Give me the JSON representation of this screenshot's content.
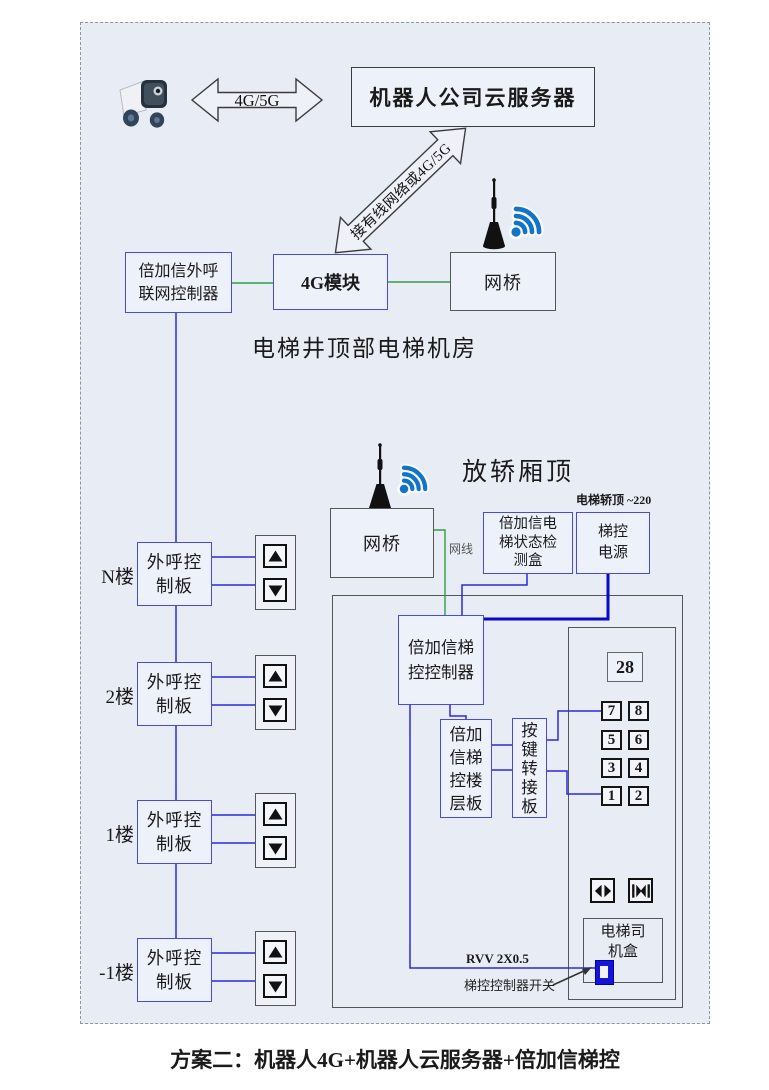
{
  "colors": {
    "page_bg": "#ffffff",
    "diagram_bg": "#e8edf5",
    "blue_box_border": "#4a4ae0",
    "gray_box_border": "#565656",
    "signal_line_blue": "#2a2ae0",
    "power_line_blue": "#0808cc",
    "network_line_green": "#2f9e43",
    "wifi_blue": "#1273c8",
    "switch_blue": "#1414d6"
  },
  "icons": {
    "robot": "delivery-robot-icon",
    "wifi": "wifi-signal-icon",
    "antenna": "antenna-icon",
    "door_open": "door-open-icon",
    "door_close": "door-close-icon",
    "up": "up-arrow-button-icon",
    "down": "down-arrow-button-icon"
  },
  "top": {
    "link_label": "4G/5G",
    "cloud_server": "机器人公司云服务器",
    "diagonal_label": "接有线网络或4G/5G"
  },
  "machine_room": {
    "controller_lines": [
      "倍加信外呼",
      "联网控制器"
    ],
    "module_4g": "4G模块",
    "bridge": "网桥",
    "caption": "电梯井顶部电梯机房"
  },
  "car_top": {
    "caption": "放轿厢顶",
    "bridge": "网桥",
    "cable_label": "网线",
    "power_note": "电梯轿顶 ~220",
    "status_lines": [
      "倍加信电",
      "梯状态检",
      "测盒"
    ],
    "power_lines": [
      "梯控",
      "电源"
    ]
  },
  "control": {
    "controller_lines": [
      "倍加信梯",
      "控控制器"
    ],
    "floor_board_lines": [
      "倍加",
      "信梯",
      "控楼",
      "层板"
    ],
    "key_adapter_lines": [
      "按",
      "键",
      "转",
      "接",
      "板"
    ],
    "display_value": "28",
    "buttons": [
      "7",
      "8",
      "5",
      "6",
      "3",
      "4",
      "1",
      "2"
    ],
    "driver_box_lines": [
      "电梯司",
      "机盒"
    ],
    "rvv_label": "RVV 2X0.5",
    "switch_label": "梯控控制器开关"
  },
  "floors": {
    "board_lines": [
      "外呼控",
      "制板"
    ],
    "items": [
      {
        "label": "N楼"
      },
      {
        "label": "2楼"
      },
      {
        "label": "1楼"
      },
      {
        "label": "-1楼"
      }
    ]
  },
  "footer": {
    "caption": "方案二：机器人4G+机器人云服务器+倍加信梯控"
  }
}
